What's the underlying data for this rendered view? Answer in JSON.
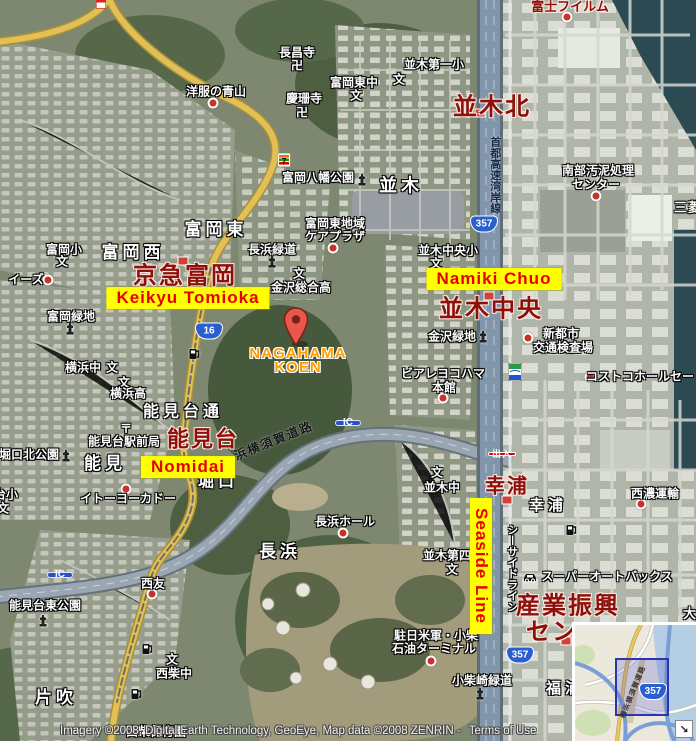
{
  "map": {
    "attribution": "Imagery ©2008, Digital Earth Technology, GeoEye, Map data ©2008 ZENRIN -",
    "terms_label": "Terms of Use",
    "colors": {
      "highlight_bg": "#ffff00",
      "highlight_text": "#e80000",
      "station_text": "#8f0f0a",
      "pin_label_orange": "#ff9c00",
      "water": "#2b4a52",
      "road_yellow": "#e2c055"
    },
    "labels": [
      {
        "text": "並木",
        "x": 401,
        "y": 186,
        "type": "area-lg",
        "size": 18
      },
      {
        "text": "富岡東",
        "x": 216,
        "y": 230,
        "type": "area-lg"
      },
      {
        "text": "富岡西",
        "x": 133,
        "y": 253,
        "type": "area-lg"
      },
      {
        "text": "能見台通",
        "x": 183,
        "y": 413,
        "type": "area-lg",
        "size": 16
      },
      {
        "text": "能見",
        "x": 105,
        "y": 464,
        "type": "area-lg"
      },
      {
        "text": "堀口",
        "x": 218,
        "y": 483,
        "type": "area-lg",
        "size": 16
      },
      {
        "text": "長浜",
        "x": 280,
        "y": 552,
        "type": "area-lg"
      },
      {
        "text": "幸浦",
        "x": 548,
        "y": 506,
        "type": "area-lg",
        "size": 15
      },
      {
        "text": "福浦",
        "x": 565,
        "y": 689,
        "type": "area-lg",
        "size": 15
      },
      {
        "text": "片吹",
        "x": 56,
        "y": 698,
        "type": "area-lg"
      },
      {
        "text": "三菱",
        "x": 688,
        "y": 208,
        "type": "area",
        "size": 13
      },
      {
        "text": "大",
        "x": 690,
        "y": 614,
        "type": "area",
        "size": 13
      },
      {
        "text": "長昌寺",
        "x": 297,
        "y": 53,
        "type": "poi"
      },
      {
        "text": "卍",
        "x": 297,
        "y": 66,
        "type": "glyph"
      },
      {
        "text": "洋服の青山",
        "x": 216,
        "y": 92,
        "type": "poi"
      },
      {
        "text": "慶珊寺",
        "x": 304,
        "y": 99,
        "type": "poi"
      },
      {
        "text": "卍",
        "x": 302,
        "y": 113,
        "type": "glyph"
      },
      {
        "text": "富岡八幡公園",
        "x": 318,
        "y": 178,
        "type": "poi"
      },
      {
        "text": "並木第一小",
        "x": 434,
        "y": 65,
        "type": "poi"
      },
      {
        "text": "文",
        "x": 399,
        "y": 80,
        "type": "glyph"
      },
      {
        "text": "富岡東中",
        "x": 354,
        "y": 83,
        "type": "poi"
      },
      {
        "text": "文",
        "x": 356,
        "y": 96,
        "type": "glyph"
      },
      {
        "text": "富岡東地域",
        "x": 335,
        "y": 224,
        "type": "poi"
      },
      {
        "text": "ケアプラザ",
        "x": 335,
        "y": 237,
        "type": "poi"
      },
      {
        "text": "長浜緑道",
        "x": 272,
        "y": 250,
        "type": "poi"
      },
      {
        "text": "富岡小",
        "x": 64,
        "y": 250,
        "type": "poi"
      },
      {
        "text": "文",
        "x": 62,
        "y": 262,
        "type": "glyph"
      },
      {
        "text": "イーズ",
        "x": 26,
        "y": 280,
        "type": "poi"
      },
      {
        "text": "富岡緑地",
        "x": 71,
        "y": 317,
        "type": "poi"
      },
      {
        "text": "金沢総合高",
        "x": 301,
        "y": 288,
        "type": "poi"
      },
      {
        "text": "文",
        "x": 299,
        "y": 274,
        "type": "glyph"
      },
      {
        "text": "横浜中",
        "x": 83,
        "y": 368,
        "type": "poi"
      },
      {
        "text": "文",
        "x": 112,
        "y": 368,
        "type": "glyph"
      },
      {
        "text": "文",
        "x": 124,
        "y": 383,
        "type": "glyph"
      },
      {
        "text": "横浜高",
        "x": 128,
        "y": 394,
        "type": "poi"
      },
      {
        "text": "並木中央小",
        "x": 448,
        "y": 251,
        "type": "poi"
      },
      {
        "text": "文",
        "x": 436,
        "y": 264,
        "type": "glyph"
      },
      {
        "text": "金沢緑地",
        "x": 452,
        "y": 337,
        "type": "poi"
      },
      {
        "text": "ビアレヨコハマ",
        "x": 443,
        "y": 374,
        "type": "poi"
      },
      {
        "text": "本館",
        "x": 444,
        "y": 388,
        "type": "poi"
      },
      {
        "text": "新都市",
        "x": 561,
        "y": 334,
        "type": "poi"
      },
      {
        "text": "交通検査場",
        "x": 563,
        "y": 348,
        "type": "poi"
      },
      {
        "text": "コストコホールセー",
        "x": 640,
        "y": 377,
        "type": "poi"
      },
      {
        "text": "南部汚泥処理",
        "x": 598,
        "y": 171,
        "type": "poi"
      },
      {
        "text": "センター",
        "x": 596,
        "y": 185,
        "type": "poi"
      },
      {
        "text": "西濃運輸",
        "x": 655,
        "y": 494,
        "type": "poi"
      },
      {
        "text": "スーパーオートバックス",
        "x": 607,
        "y": 577,
        "type": "poi"
      },
      {
        "text": "能見台駅前局",
        "x": 124,
        "y": 442,
        "type": "poi"
      },
      {
        "text": "〒",
        "x": 126,
        "y": 429,
        "type": "glyph"
      },
      {
        "text": "能見台小",
        "x": -6,
        "y": 495,
        "type": "poi"
      },
      {
        "text": "文",
        "x": 3,
        "y": 509,
        "type": "glyph"
      },
      {
        "text": "堀口北公園",
        "x": 29,
        "y": 455,
        "type": "poi"
      },
      {
        "text": "イトーヨーカドー",
        "x": 128,
        "y": 499,
        "type": "poi"
      },
      {
        "text": "西友",
        "x": 153,
        "y": 584,
        "type": "poi"
      },
      {
        "text": "能見台東公園",
        "x": 45,
        "y": 606,
        "type": "poi"
      },
      {
        "text": "西柴中",
        "x": 174,
        "y": 674,
        "type": "poi"
      },
      {
        "text": "文",
        "x": 172,
        "y": 660,
        "type": "glyph"
      },
      {
        "text": "西柴保育園",
        "x": 156,
        "y": 732,
        "type": "poi"
      },
      {
        "text": "並木中",
        "x": 442,
        "y": 488,
        "type": "poi"
      },
      {
        "text": "文",
        "x": 437,
        "y": 473,
        "type": "glyph"
      },
      {
        "text": "並木第四",
        "x": 447,
        "y": 556,
        "type": "poi"
      },
      {
        "text": "文",
        "x": 452,
        "y": 570,
        "type": "glyph"
      },
      {
        "text": "長浜ホール",
        "x": 345,
        "y": 522,
        "type": "poi"
      },
      {
        "text": "駐日米軍・小柴",
        "x": 436,
        "y": 636,
        "type": "poi"
      },
      {
        "text": "石油ターミナル",
        "x": 434,
        "y": 649,
        "type": "poi"
      },
      {
        "text": "小柴崎緑道",
        "x": 482,
        "y": 681,
        "type": "poi"
      },
      {
        "text": "並木北",
        "x": 492,
        "y": 107,
        "type": "station"
      },
      {
        "text": "京急富岡",
        "x": 185,
        "y": 276,
        "type": "station"
      },
      {
        "text": "並木中央",
        "x": 491,
        "y": 309,
        "type": "station"
      },
      {
        "text": "能見台",
        "x": 203,
        "y": 439,
        "type": "station",
        "size": 22
      },
      {
        "text": "幸浦",
        "x": 507,
        "y": 487,
        "type": "station",
        "size": 20
      },
      {
        "text": "産業振興",
        "x": 568,
        "y": 606,
        "type": "station"
      },
      {
        "text": "セン",
        "x": 552,
        "y": 632,
        "type": "station"
      },
      {
        "text": "富士フイルム",
        "x": 570,
        "y": 7,
        "type": "poi-red"
      },
      {
        "text": "首都高速湾岸線",
        "x": 494,
        "y": 175,
        "type": "road-v-dark"
      },
      {
        "text": "シーサイドライン",
        "x": 511,
        "y": 568,
        "type": "road-v"
      },
      {
        "text": "浜横須賀道路",
        "x": 274,
        "y": 441,
        "type": "road-d",
        "rot": -22
      },
      {
        "text": "Keikyu Tomioka",
        "x": 188,
        "y": 298,
        "type": "hl"
      },
      {
        "text": "Namiki Chuo",
        "x": 494,
        "y": 279,
        "type": "hl"
      },
      {
        "text": "Nomidai",
        "x": 188,
        "y": 467,
        "type": "hl"
      },
      {
        "text": "Seaside Line",
        "x": 481,
        "y": 566,
        "type": "hl",
        "rot": 90
      },
      {
        "text": "NAGAHAMA",
        "x": 298,
        "y": 354,
        "type": "orange"
      },
      {
        "text": "KOEN",
        "x": 298,
        "y": 368,
        "type": "orange"
      }
    ],
    "markers": [
      {
        "k": "monument",
        "name": "monument-icon",
        "x": 362,
        "y": 180
      },
      {
        "k": "monument",
        "name": "monument-icon",
        "x": 272,
        "y": 262
      },
      {
        "k": "monument",
        "name": "monument-icon",
        "x": 70,
        "y": 329
      },
      {
        "k": "monument",
        "name": "monument-icon",
        "x": 66,
        "y": 456
      },
      {
        "k": "monument",
        "name": "monument-icon",
        "x": 43,
        "y": 621
      },
      {
        "k": "monument",
        "name": "monument-icon",
        "x": 483,
        "y": 337
      },
      {
        "k": "monument",
        "name": "monument-icon",
        "x": 480,
        "y": 694
      },
      {
        "k": "gas",
        "name": "gas-station-icon",
        "x": 194,
        "y": 354
      },
      {
        "k": "gas",
        "name": "gas-station-icon",
        "x": 571,
        "y": 530
      },
      {
        "k": "gas",
        "name": "gas-station-icon",
        "x": 147,
        "y": 649
      },
      {
        "k": "gas",
        "name": "gas-station-icon",
        "x": 136,
        "y": 694
      },
      {
        "k": "car",
        "name": "car-shop-icon",
        "x": 530,
        "y": 577
      },
      {
        "k": "seven",
        "name": "seven-eleven-icon",
        "x": 284,
        "y": 160
      },
      {
        "k": "sst",
        "name": "seaside-station-icon",
        "x": 515,
        "y": 372
      },
      {
        "k": "store",
        "name": "store-icon",
        "x": 101,
        "y": 4
      },
      {
        "k": "dot",
        "name": "poi-dot",
        "x": 213,
        "y": 103
      },
      {
        "k": "dot",
        "name": "poi-dot",
        "x": 48,
        "y": 280
      },
      {
        "k": "dot",
        "name": "poi-dot",
        "x": 333,
        "y": 248
      },
      {
        "k": "dot",
        "name": "poi-dot",
        "x": 596,
        "y": 196
      },
      {
        "k": "dot",
        "name": "poi-dot",
        "x": 567,
        "y": 17
      },
      {
        "k": "dot",
        "name": "poi-dot",
        "x": 528,
        "y": 338
      },
      {
        "k": "dot",
        "name": "poi-dot",
        "x": 590,
        "y": 377
      },
      {
        "k": "dot",
        "name": "poi-dot",
        "x": 641,
        "y": 504
      },
      {
        "k": "dot",
        "name": "poi-dot",
        "x": 443,
        "y": 398
      },
      {
        "k": "dot",
        "name": "poi-dot",
        "x": 126,
        "y": 489
      },
      {
        "k": "dot",
        "name": "poi-dot",
        "x": 152,
        "y": 594
      },
      {
        "k": "dot",
        "name": "poi-dot",
        "x": 343,
        "y": 533
      },
      {
        "k": "dot",
        "name": "poi-dot",
        "x": 431,
        "y": 661
      },
      {
        "k": "stmark",
        "name": "station-marker",
        "x": 480,
        "y": 113
      },
      {
        "k": "stmark",
        "name": "station-marker",
        "x": 183,
        "y": 261
      },
      {
        "k": "stmark",
        "name": "station-marker",
        "x": 489,
        "y": 296
      },
      {
        "k": "stmark",
        "name": "station-marker",
        "x": 174,
        "y": 438
      },
      {
        "k": "stmark",
        "name": "station-marker",
        "x": 507,
        "y": 500
      },
      {
        "k": "stmark",
        "name": "station-marker",
        "x": 566,
        "y": 641
      },
      {
        "k": "ic",
        "name": "ic-badge",
        "text": "IC",
        "x": 348,
        "y": 423
      },
      {
        "k": "ic",
        "name": "ic-badge",
        "text": "IC",
        "x": 60,
        "y": 575
      },
      {
        "k": "shield",
        "name": "route-357-shield",
        "text": "357",
        "x": 484,
        "y": 224
      },
      {
        "k": "shield",
        "name": "route-357-shield",
        "text": "357",
        "x": 520,
        "y": 655
      },
      {
        "k": "shield",
        "name": "route-16-shield",
        "text": "16",
        "x": 209,
        "y": 331
      },
      {
        "k": "deiri",
        "name": "exit-badge",
        "text": "出入",
        "x": 502,
        "y": 454
      }
    ]
  },
  "inset": {
    "route_shield": "357",
    "road_label": "横浜横須賀道路",
    "collapse_arrow": "↘"
  }
}
